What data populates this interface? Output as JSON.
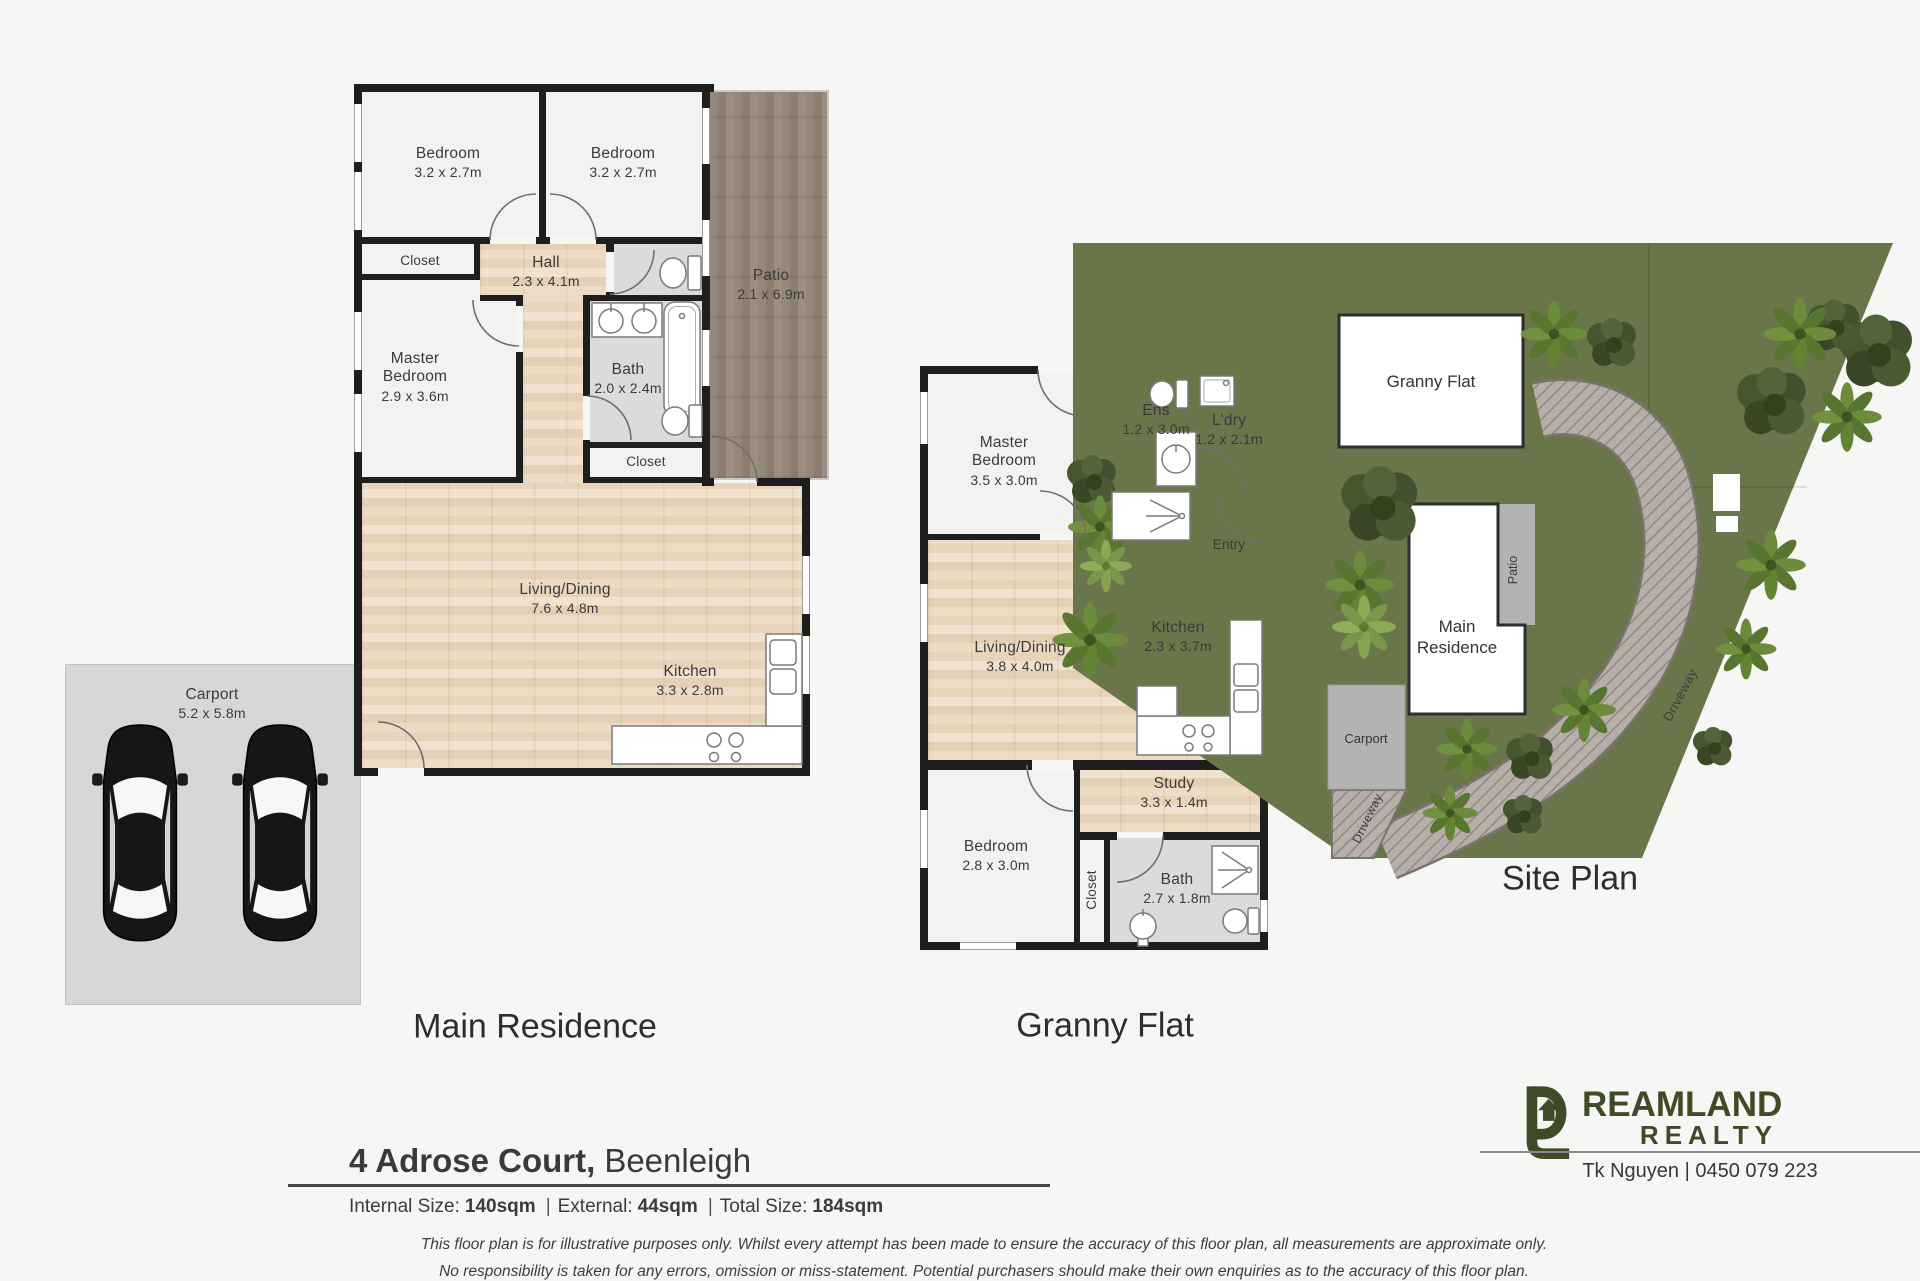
{
  "colors": {
    "brand_olive": "#3f4a26",
    "site_green": "#68764a",
    "wall": "#1e1e1e",
    "wood": "#e8d5ba",
    "patio_deck": "#8f8376",
    "gray_room": "#dbdbd9"
  },
  "titles": {
    "main_residence": "Main Residence",
    "granny_flat": "Granny Flat",
    "site_plan": "Site Plan"
  },
  "main_residence": {
    "rooms": {
      "bedroom1": {
        "name": "Bedroom",
        "dims": "3.2 x 2.7m"
      },
      "bedroom2": {
        "name": "Bedroom",
        "dims": "3.2 x 2.7m"
      },
      "patio": {
        "name": "Patio",
        "dims": "2.1 x 6.9m"
      },
      "closet1": {
        "name": "Closet"
      },
      "hall": {
        "name": "Hall",
        "dims": "2.3 x 4.1m"
      },
      "master_bedroom": {
        "name": "Master Bedroom",
        "dims": "2.9 x 3.6m"
      },
      "bath": {
        "name": "Bath",
        "dims": "2.0 x 2.4m"
      },
      "closet2": {
        "name": "Closet"
      },
      "living_dining": {
        "name": "Living/Dining",
        "dims": "7.6 x 4.8m"
      },
      "kitchen": {
        "name": "Kitchen",
        "dims": "3.3 x 2.8m"
      }
    }
  },
  "carport": {
    "name": "Carport",
    "dims": "5.2 x 5.8m"
  },
  "granny_flat": {
    "rooms": {
      "master_bedroom": {
        "name": "Master Bedroom",
        "dims": "3.5 x 3.0m"
      },
      "ens": {
        "name": "Ens",
        "dims": "1.2 x 3.0m"
      },
      "ldry": {
        "name": "L'dry",
        "dims": "1.2 x 2.1m"
      },
      "entry": {
        "name": "Entry"
      },
      "living_dining": {
        "name": "Living/Dining",
        "dims": "3.8 x 4.0m"
      },
      "kitchen": {
        "name": "Kitchen",
        "dims": "2.3 x 3.7m"
      },
      "study": {
        "name": "Study",
        "dims": "3.3 x 1.4m"
      },
      "bedroom": {
        "name": "Bedroom",
        "dims": "2.8 x 3.0m"
      },
      "closet": {
        "name": "Closet"
      },
      "bath": {
        "name": "Bath",
        "dims": "2.7 x 1.8m"
      }
    }
  },
  "site_plan": {
    "labels": {
      "granny_flat": "Granny Flat",
      "main_line1": "Main",
      "main_line2": "Residence",
      "patio": "Patio",
      "carport": "Carport",
      "driveway": "Driveway"
    }
  },
  "footer": {
    "address_bold": "4 Adrose Court,",
    "address_suburb": "Beenleigh",
    "internal_label": "Internal Size:",
    "internal_value": "140sqm",
    "external_label": "External:",
    "external_value": "44sqm",
    "total_label": "Total Size:",
    "total_value": "184sqm",
    "separator": "|",
    "agent": "Tk Nguyen | 0450 079 223",
    "disclaimer_line1": "This floor plan is for illustrative purposes only. Whilst every attempt has been made to ensure the accuracy of this floor plan, all measurements are approximate only.",
    "disclaimer_line2": "No responsibility is taken for any errors, omission or miss-statement. Potential purchasers should make their own enquiries as to the accuracy of this floor plan."
  },
  "brand": {
    "name": "DREAMLAND REALTY",
    "wordmark_tail": "REAMLAND",
    "realty": "REALTY"
  }
}
